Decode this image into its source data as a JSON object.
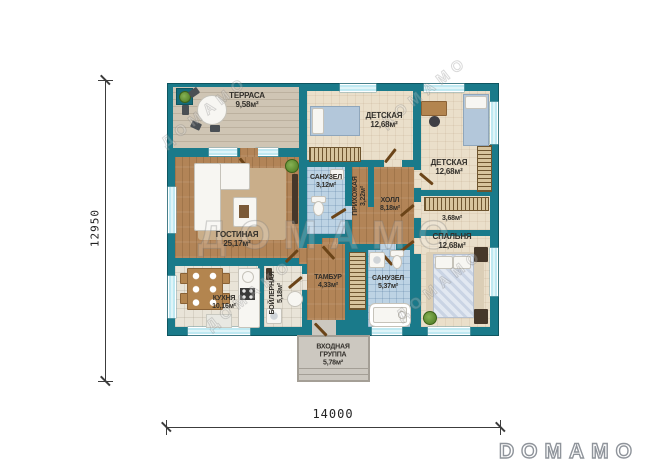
{
  "branding": {
    "logo": "DOMAMO",
    "watermark": "ДОМАМО"
  },
  "dimensions": {
    "width": "14000",
    "height": "12950"
  },
  "rooms": {
    "terrace": {
      "name": "ТЕРРАСА",
      "area": "9,58м²"
    },
    "nursery_top": {
      "name": "ДЕТСКАЯ",
      "area": "12,68м²"
    },
    "nursery_right": {
      "name": "ДЕТСКАЯ",
      "area": "12,68м²"
    },
    "bath_small": {
      "name": "САНУЗЕЛ",
      "area": "3,12м²"
    },
    "entry_hall": {
      "name": "ПРИХОЖАЯ",
      "area": "3,22м²"
    },
    "hall": {
      "name": "ХОЛЛ",
      "area": "8,18м²"
    },
    "wardrobe": {
      "name": "",
      "area": "3,68м²"
    },
    "bedroom": {
      "name": "СПАЛЬНЯ",
      "area": "12,68м²"
    },
    "living": {
      "name": "ГОСТИНАЯ",
      "area": "25,17м²"
    },
    "kitchen": {
      "name": "КУХНЯ",
      "area": "10,16м²"
    },
    "boiler": {
      "name": "БОЙЛЕРНАЯ",
      "area": "5,18м²"
    },
    "tambour": {
      "name": "ТАМБУР",
      "area": "4,33м²"
    },
    "bath_main": {
      "name": "САНУЗЕЛ",
      "area": "5,37м²"
    },
    "entrance_group": {
      "name_line1": "ВХОДНАЯ",
      "name_line2": "ГРУППА",
      "area": "5,78м²"
    }
  }
}
